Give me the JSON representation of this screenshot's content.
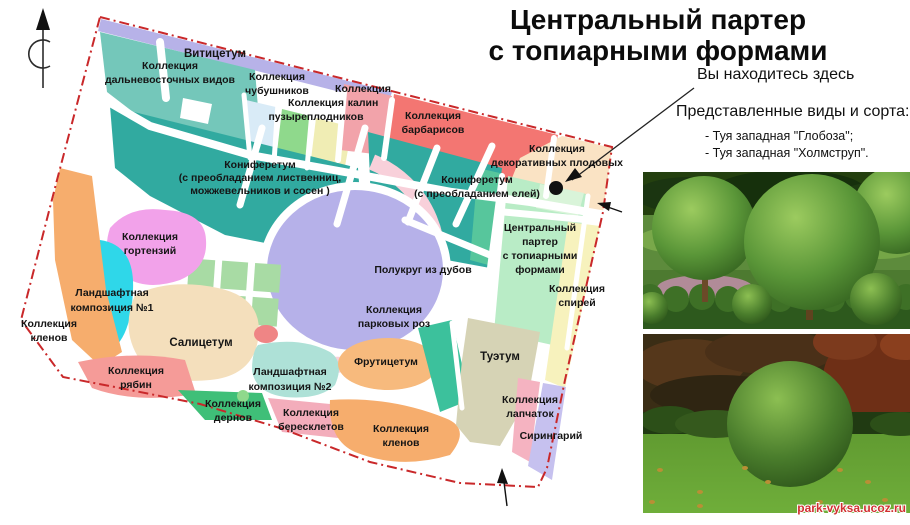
{
  "title": {
    "line1": "Центральный партер",
    "line2": "с топиарными формами"
  },
  "legend": {
    "you_are_here": "Вы находитесь здесь",
    "species_heading": "Представленные виды и сорта:",
    "species": [
      "- Туя западная \"Глобоза\";",
      "- Туя западная \"Холмструп\"."
    ]
  },
  "watermark": "park-vyksa.ucoz.ru",
  "colors": {
    "border": "#c9282a",
    "marker": "#111111",
    "teal_light": "#74c7ba",
    "teal_dark": "#31aaa0",
    "lavender_strip": "#b7b2e8",
    "light_blue": "#d9ebf7",
    "light_green": "#8fd98c",
    "pale_yellow": "#f0edb4",
    "rose": "#f2a3aa",
    "red_zone": "#f37672",
    "peach": "#fae3c4",
    "parter_green": "#b9ecc6",
    "parter_strip": "#57c69c",
    "parter_inner": "#d9f4d9",
    "spirea_yellow": "#f7f2bd",
    "ring_pink": "#f8d0da",
    "oak_lavender": "#b6b1e9",
    "hydrangea_pink": "#f2a2ea",
    "cyan": "#2fd7e9",
    "orange": "#f6ad6d",
    "cream": "#f4dfbc",
    "salmon": "#f59b98",
    "green_deren": "#3fbf78",
    "mint": "#aee1d7",
    "pink_beresklet": "#f3adbb",
    "orange_fruit": "#f7ba7d",
    "tan": "#d6d3b5",
    "pink_lapchatka": "#f5b3c1",
    "lavender_siringa": "#c6c1ef",
    "teal_wedge": "#3cc19c",
    "squares_green": "#a8dba4",
    "red_small": "#ef8585"
  },
  "map": {
    "labels": {
      "vititsetum": {
        "lines": [
          "Витицетум"
        ]
      },
      "far_east": {
        "lines": [
          "Коллекция",
          "дальневосточных видов"
        ]
      },
      "chubushnik": {
        "lines": [
          "Коллекция",
          "чубушников"
        ]
      },
      "puzyreplodnik": {
        "lines": [
          "Коллекция",
          "пузыреплодников"
        ]
      },
      "kalina": {
        "lines": [
          "Коллекция",
          "калин"
        ]
      },
      "barbaris": {
        "lines": [
          "Коллекция",
          "барбарисов"
        ]
      },
      "dekor_plod": {
        "lines": [
          "Коллекция",
          "декоративных плодовых"
        ]
      },
      "konif_listv": {
        "lines": [
          "Кониферетум",
          "(с преобладанием лиственниц,",
          "можжевельников и сосен )"
        ]
      },
      "konif_eli": {
        "lines": [
          "Кониферетум",
          "(с преобладанием елей)"
        ]
      },
      "central_parter": {
        "lines": [
          "Центральный",
          "партер",
          "с топиарными",
          "формами"
        ]
      },
      "spirea": {
        "lines": [
          "Коллекция",
          "спирей"
        ]
      },
      "polukrug": {
        "lines": [
          "Полукруг из дубов"
        ]
      },
      "park_roses": {
        "lines": [
          "Коллекция",
          "парковых роз"
        ]
      },
      "gortenzia": {
        "lines": [
          "Коллекция",
          "гортензий"
        ]
      },
      "lk1": {
        "lines": [
          "Ландшафтная",
          "композиция №1"
        ]
      },
      "klen_left": {
        "lines": [
          "Коллекция",
          "кленов"
        ]
      },
      "salicetum": {
        "lines": [
          "Салицетум"
        ]
      },
      "ryabina": {
        "lines": [
          "Коллекция",
          "рябин"
        ]
      },
      "deren": {
        "lines": [
          "Коллекция",
          "дернов"
        ]
      },
      "lk2": {
        "lines": [
          "Ландшафтная",
          "композиция №2"
        ]
      },
      "beresklet": {
        "lines": [
          "Коллекция",
          "бересклетов"
        ]
      },
      "klen_bottom": {
        "lines": [
          "Коллекция",
          "кленов"
        ]
      },
      "fruticetum": {
        "lines": [
          "Фрутицетум"
        ]
      },
      "tuetum": {
        "lines": [
          "Туэтум"
        ]
      },
      "lapchatka": {
        "lines": [
          "Коллекция",
          "лапчаток"
        ]
      },
      "siringary": {
        "lines": [
          "Сирингарий"
        ]
      }
    }
  }
}
